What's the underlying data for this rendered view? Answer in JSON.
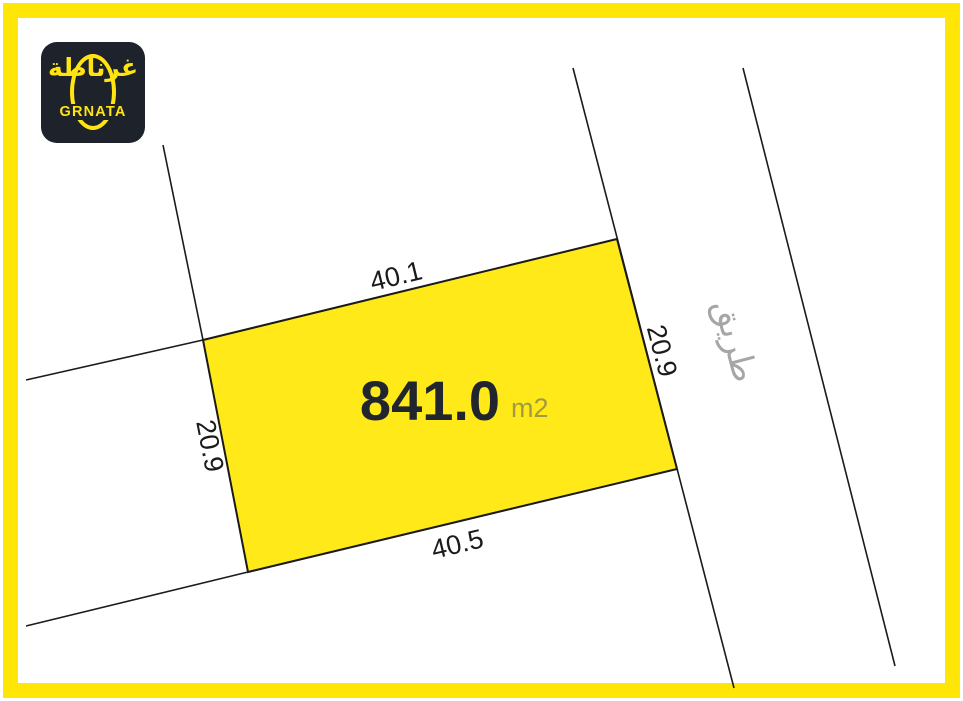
{
  "branding": {
    "logo_arabic": "غرناطة",
    "logo_latin": "GRNATA"
  },
  "parcel": {
    "area_value": "841.0",
    "area_unit": "m2",
    "dimensions": {
      "top": "40.1",
      "bottom": "40.5",
      "left": "20.9",
      "right": "20.9"
    }
  },
  "road": {
    "label": "طريق"
  },
  "colors": {
    "frame_yellow": "#ffe606",
    "parcel_yellow": "#ffe919",
    "line_dark": "#1b1b1b",
    "logo_background": "#1d222b",
    "logo_yellow": "#ffe412",
    "area_text": "#20252e",
    "area_unit_text": "#a09a45",
    "road_text": "#a6a6a6"
  }
}
